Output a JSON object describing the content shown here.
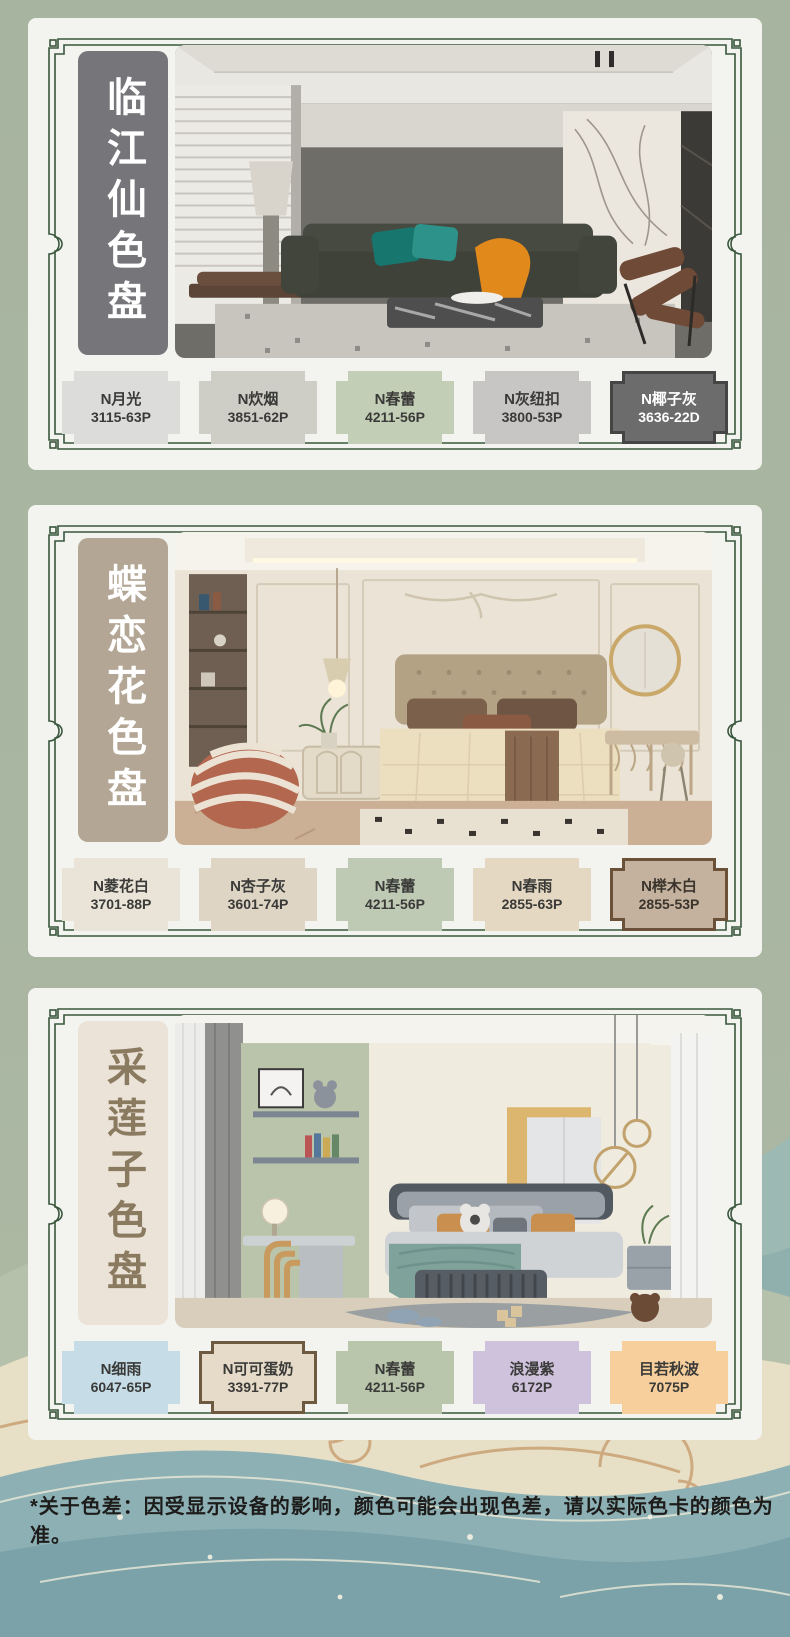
{
  "page": {
    "background_color": "#a9b6a1",
    "card_color": "#f3f4ef",
    "frame_color": "#39563d",
    "footnote": "*关于色差：因受显示设备的影响，颜色可能会出现色差，请以实际色卡的颜色为准。"
  },
  "sections": [
    {
      "title": "临江仙色盘",
      "plaque": {
        "bg": "#76767a",
        "color": "#ffffff"
      },
      "photo": "modern-living-room-photo",
      "swatches": [
        {
          "name": "N月光",
          "code": "3115-63P",
          "fill": "#dcdcda",
          "text": "#3a3a38"
        },
        {
          "name": "N炊烟",
          "code": "3851-62P",
          "fill": "#cfcec6",
          "text": "#3a3a38"
        },
        {
          "name": "N春蕾",
          "code": "4211-56P",
          "fill": "#c3ceb7",
          "text": "#3a3a38"
        },
        {
          "name": "N灰纽扣",
          "code": "3800-53P",
          "fill": "#c7c6c4",
          "text": "#3a3a38"
        },
        {
          "name": "N椰子灰",
          "code": "3636-22D",
          "fill": "#6c6c6c",
          "text": "#ffffff",
          "border": "#454545"
        }
      ]
    },
    {
      "title": "蝶恋花色盘",
      "plaque": {
        "bg": "#b3a695",
        "color": "#ffffff"
      },
      "photo": "french-cream-bedroom-photo",
      "swatches": [
        {
          "name": "N菱花白",
          "code": "3701-88P",
          "fill": "#eae4d8",
          "text": "#3a3a38"
        },
        {
          "name": "N杏子灰",
          "code": "3601-74P",
          "fill": "#ded5c5",
          "text": "#3a3a38"
        },
        {
          "name": "N春蕾",
          "code": "4211-56P",
          "fill": "#bfcab4",
          "text": "#3a3a38"
        },
        {
          "name": "N春雨",
          "code": "2855-63P",
          "fill": "#e4d8c2",
          "text": "#3a3a38"
        },
        {
          "name": "N榉木白",
          "code": "2855-53P",
          "fill": "#c4b29e",
          "text": "#3a342c",
          "border": "#6a5138"
        }
      ]
    },
    {
      "title": "采莲子色盘",
      "plaque": {
        "bg": "#ebe2d8",
        "color": "#8a7a5f"
      },
      "photo": "kids-bedroom-photo",
      "swatches": [
        {
          "name": "N细雨",
          "code": "6047-65P",
          "fill": "#c6dde7",
          "text": "#3a3a38"
        },
        {
          "name": "N可可蛋奶",
          "code": "3391-77P",
          "fill": "#e6dac8",
          "text": "#3a3a38",
          "border": "#6d5a41"
        },
        {
          "name": "N春蕾",
          "code": "4211-56P",
          "fill": "#b9c6ac",
          "text": "#3a3a38"
        },
        {
          "name": "浪漫紫",
          "code": "6172P",
          "fill": "#cfc2dd",
          "text": "#3a3a38"
        },
        {
          "name": "目若秋波",
          "code": "7075P",
          "fill": "#f7cf9d",
          "text": "#3a3a38"
        }
      ]
    }
  ]
}
